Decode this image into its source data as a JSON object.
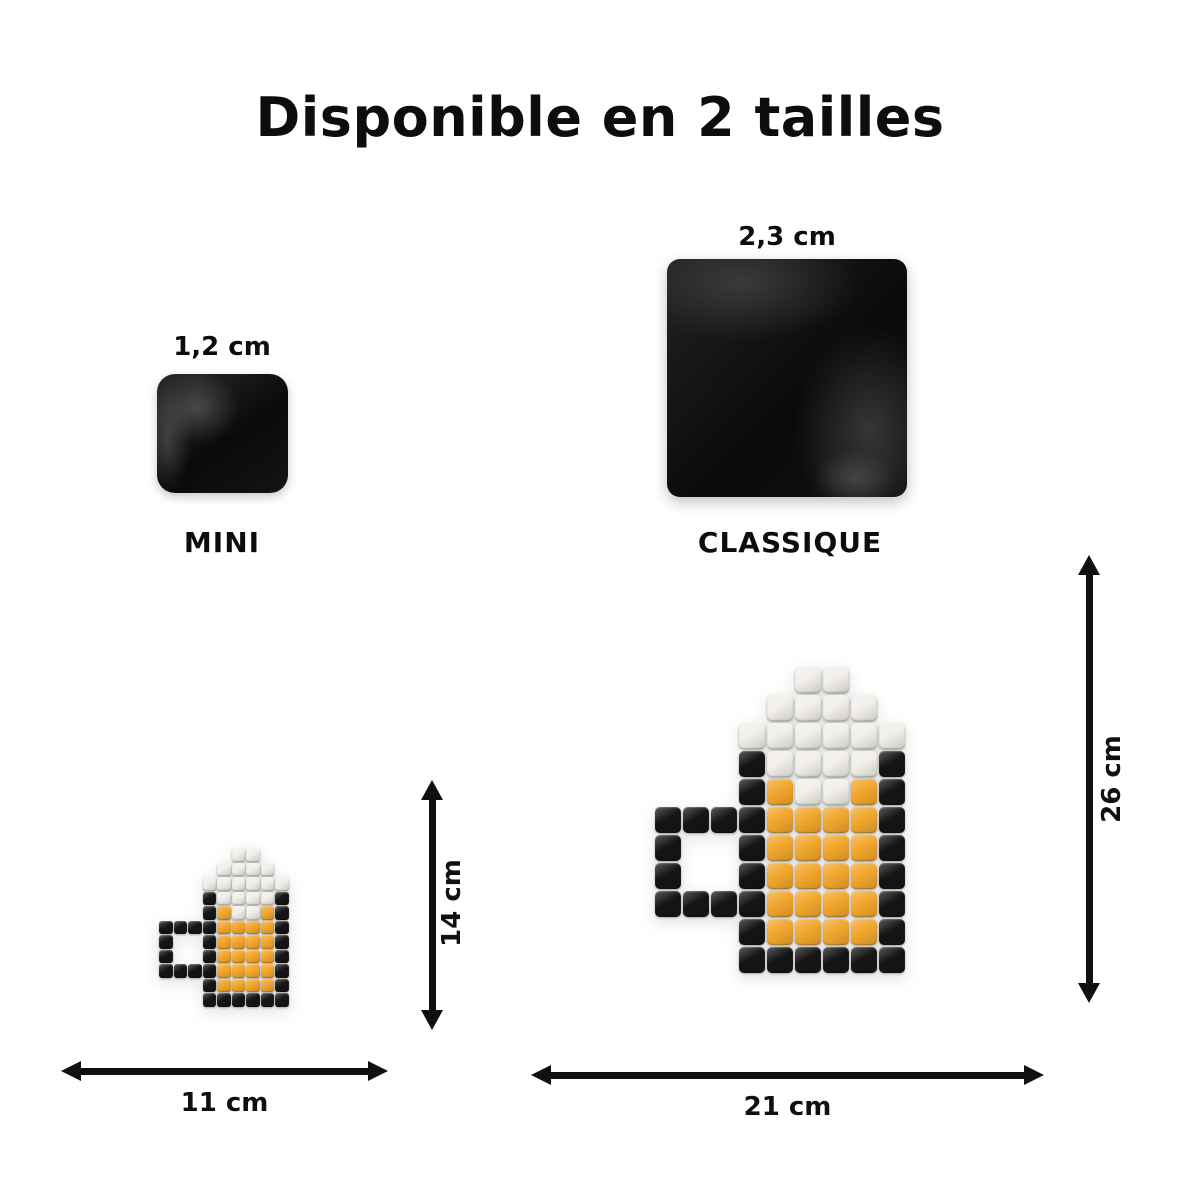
{
  "title": "Disponible en 2 tailles",
  "tiles": {
    "mini": {
      "size_label": "1,2 cm",
      "name": "MINI"
    },
    "classique": {
      "size_label": "2,3 cm",
      "name": "CLASSIQUE"
    }
  },
  "mugs": {
    "palette": {
      "W": "#f1efe8",
      "K": "#151515",
      "O": "#f2a72d"
    },
    "pixel_map": [
      ".....WW..",
      "....WWWW.",
      "...WWWWWW",
      "...KWWWWK",
      "...KOWWOK",
      "KKKKOOOOK",
      "K..KOOOOK",
      "K..KOOOOK",
      "KKKKOOOOK",
      "...KOOOOK",
      "...KKKKKK"
    ],
    "small": {
      "width_label": "11 cm",
      "height_label": "14 cm"
    },
    "large": {
      "width_label": "21 cm",
      "height_label": "26 cm"
    }
  },
  "colors": {
    "background": "#ffffff",
    "text": "#101010",
    "arrow": "#101010"
  }
}
